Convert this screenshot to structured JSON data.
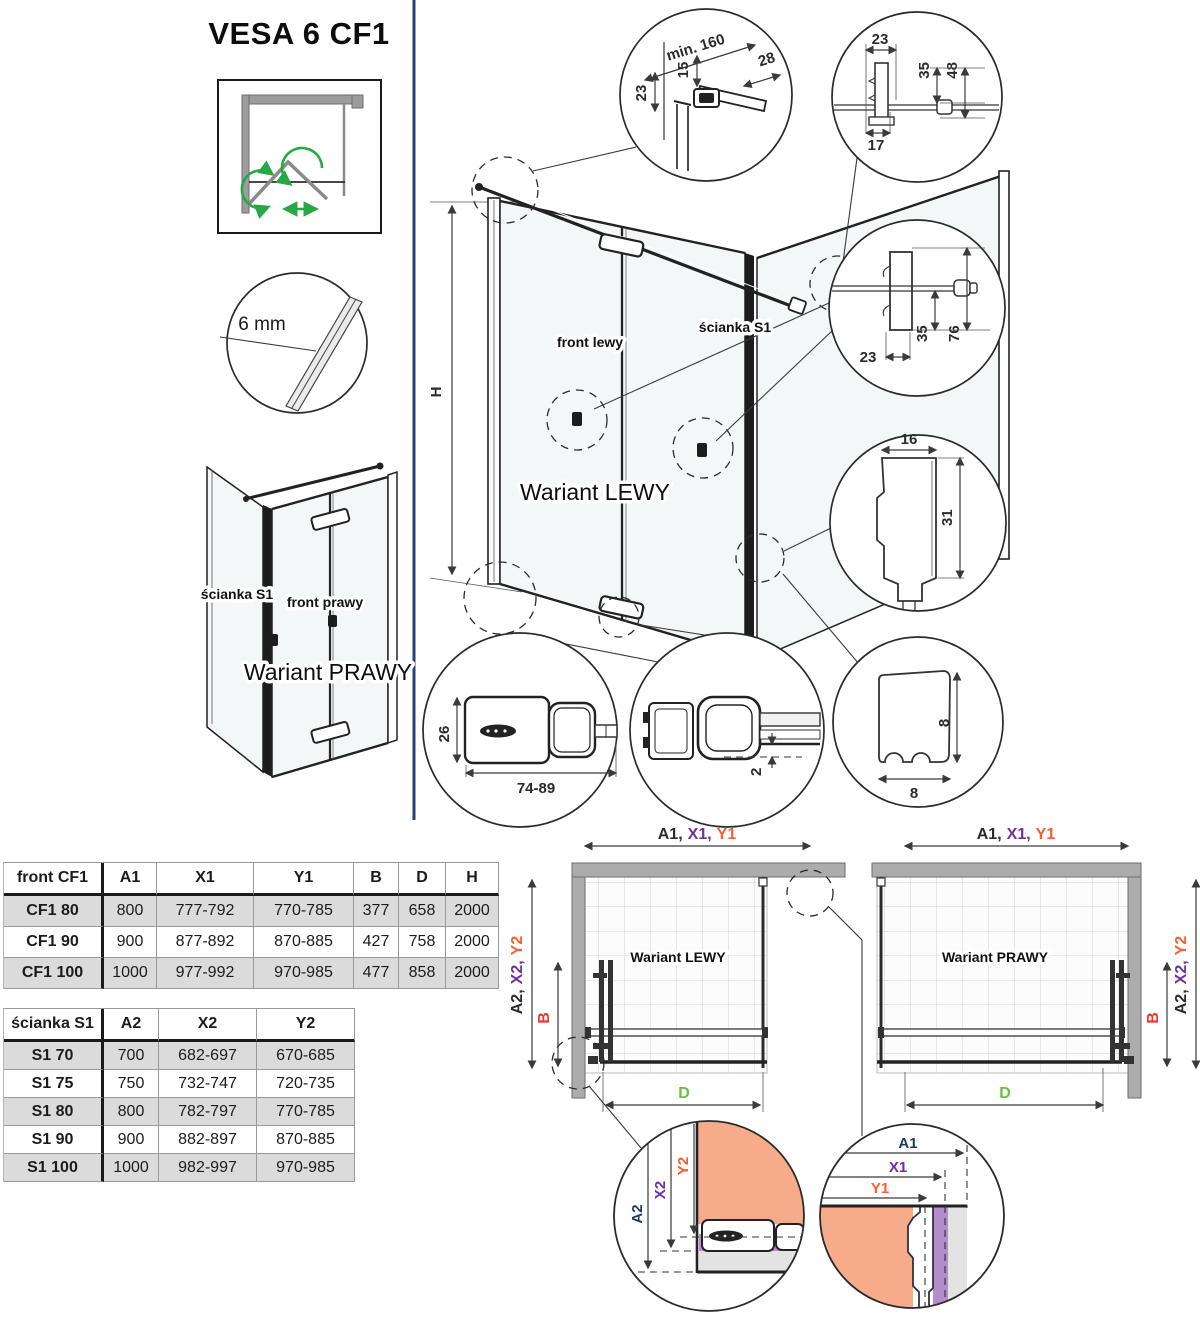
{
  "title": "VESA 6 CF1",
  "glass_detail": {
    "label": "6 mm"
  },
  "variant_right_iso": {
    "wall_label": "ścianka S1",
    "front_label": "front prawy",
    "name": "Wariant PRAWY"
  },
  "main_iso": {
    "front_label": "front lewy",
    "wall_label": "ścianka S1",
    "name": "Wariant LEWY",
    "height_label": "H"
  },
  "details": {
    "hinge_top": {
      "d1": "min. 160",
      "d2": "28",
      "d3": "15",
      "d4": "23"
    },
    "stabilizer": {
      "d1": "23",
      "d2": "35",
      "d3": "48",
      "d4": "17"
    },
    "wall_bracket": {
      "d1": "23",
      "d2": "35",
      "d3": "76"
    },
    "wall_profile": {
      "width": "16",
      "height": "31"
    },
    "holder": {
      "height": "26",
      "width": "74-89"
    },
    "bottom_gap": {
      "gap": "2"
    },
    "seal": {
      "height": "8",
      "width": "8"
    }
  },
  "front_table": {
    "header": {
      "name": "front CF1",
      "a": "A1",
      "x": "X1",
      "y": "Y1",
      "b": "B",
      "d": "D",
      "h": "H"
    },
    "rows": [
      {
        "name": "CF1 80",
        "a": "800",
        "x": "777-792",
        "y": "770-785",
        "b": "377",
        "d": "658",
        "h": "2000"
      },
      {
        "name": "CF1 90",
        "a": "900",
        "x": "877-892",
        "y": "870-885",
        "b": "427",
        "d": "758",
        "h": "2000"
      },
      {
        "name": "CF1 100",
        "a": "1000",
        "x": "977-992",
        "y": "970-985",
        "b": "477",
        "d": "858",
        "h": "2000"
      }
    ]
  },
  "wall_table": {
    "header": {
      "name": "ścianka S1",
      "a": "A2",
      "x": "X2",
      "y": "Y2"
    },
    "rows": [
      {
        "name": "S1 70",
        "a": "700",
        "x": "682-697",
        "y": "670-685"
      },
      {
        "name": "S1 75",
        "a": "750",
        "x": "732-747",
        "y": "720-735"
      },
      {
        "name": "S1 80",
        "a": "800",
        "x": "782-797",
        "y": "770-785"
      },
      {
        "name": "S1 90",
        "a": "900",
        "x": "882-897",
        "y": "870-885"
      },
      {
        "name": "S1 100",
        "a": "1000",
        "x": "982-997",
        "y": "970-985"
      }
    ]
  },
  "plans": {
    "left_name": "Wariant LEWY",
    "right_name": "Wariant PRAWY",
    "dim_front": {
      "a": "A1,",
      "x": "X1,",
      "y": "Y1"
    },
    "dim_side": {
      "a": "A2,",
      "x": "X2,",
      "y": "Y2"
    },
    "dim_b": "B",
    "dim_d": "D"
  },
  "install": {
    "left": {
      "a": "A2",
      "x": "X2",
      "y": "Y2"
    },
    "right": {
      "a": "A1",
      "x": "X1",
      "y": "Y1"
    }
  },
  "colors": {
    "purple": "#7030A0",
    "orange": "#FB5D33",
    "red": "#F0342F",
    "green": "#6CBE45",
    "navy": "#1F3B5C",
    "salmon": "#F6AB8B",
    "violet_fill": "#B48BCB",
    "wall_gray": "#ACACAC",
    "row_shade": "#DBDBDB",
    "divider": "#2B3F72"
  }
}
